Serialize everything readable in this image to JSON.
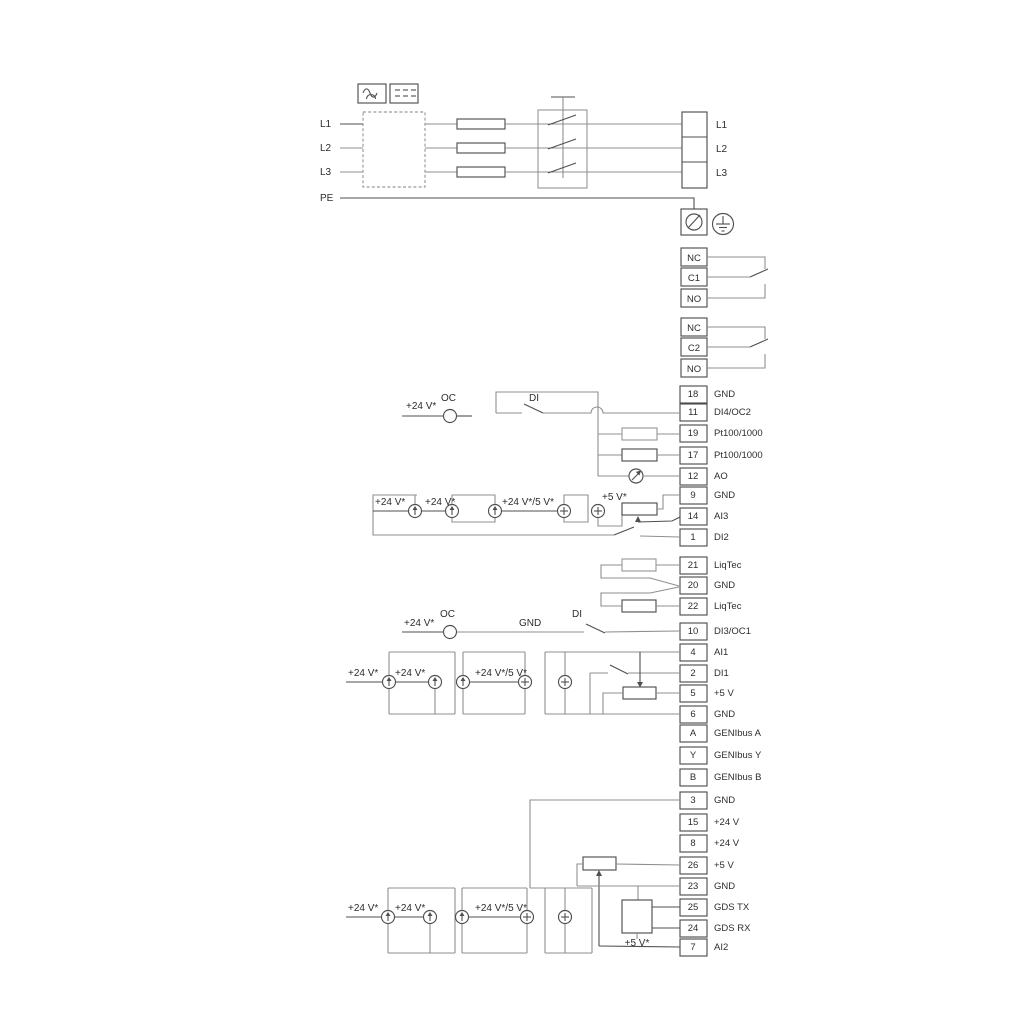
{
  "power": {
    "input_lines": [
      "L1",
      "L2",
      "L3",
      "PE"
    ],
    "output_terminals": [
      "L1",
      "L2",
      "L3"
    ]
  },
  "relays": {
    "relay1": [
      "NC",
      "C1",
      "NO"
    ],
    "relay2": [
      "NC",
      "C2",
      "NO"
    ]
  },
  "strips": {
    "io1": [
      {
        "id": "18",
        "label": "GND"
      },
      {
        "id": "11",
        "label": "DI4/OC2"
      },
      {
        "id": "19",
        "label": "Pt100/1000"
      },
      {
        "id": "17",
        "label": "Pt100/1000"
      },
      {
        "id": "12",
        "label": "AO"
      },
      {
        "id": "9",
        "label": "GND"
      },
      {
        "id": "14",
        "label": "AI3"
      },
      {
        "id": "1",
        "label": "DI2"
      }
    ],
    "liqtec": [
      {
        "id": "21",
        "label": "LiqTec"
      },
      {
        "id": "20",
        "label": "GND"
      },
      {
        "id": "22",
        "label": "LiqTec"
      }
    ],
    "io2": [
      {
        "id": "10",
        "label": "DI3/OC1"
      },
      {
        "id": "4",
        "label": "AI1"
      },
      {
        "id": "2",
        "label": "DI1"
      },
      {
        "id": "5",
        "label": "+5 V"
      },
      {
        "id": "6",
        "label": "GND"
      },
      {
        "id": "A",
        "label": "GENIbus A"
      },
      {
        "id": "Y",
        "label": "GENIbus Y"
      },
      {
        "id": "B",
        "label": "GENIbus B"
      }
    ],
    "io3": [
      {
        "id": "3",
        "label": "GND"
      },
      {
        "id": "15",
        "label": "+24 V"
      },
      {
        "id": "8",
        "label": "+24 V"
      },
      {
        "id": "26",
        "label": "+5 V"
      },
      {
        "id": "23",
        "label": "GND"
      },
      {
        "id": "25",
        "label": "GDS TX"
      },
      {
        "id": "24",
        "label": "GDS RX"
      },
      {
        "id": "7",
        "label": "AI2"
      }
    ]
  },
  "annotations": {
    "v24": "+24 V*",
    "v24_5": "+24 V*/5 V*",
    "v5": "+5 V*",
    "oc": "OC",
    "di": "DI",
    "gnd": "GND"
  },
  "colors": {
    "background": "#ffffff",
    "line_gray": "#8f8f8f",
    "line_dark": "#4f4f4f",
    "text": "#2d2d2d"
  }
}
